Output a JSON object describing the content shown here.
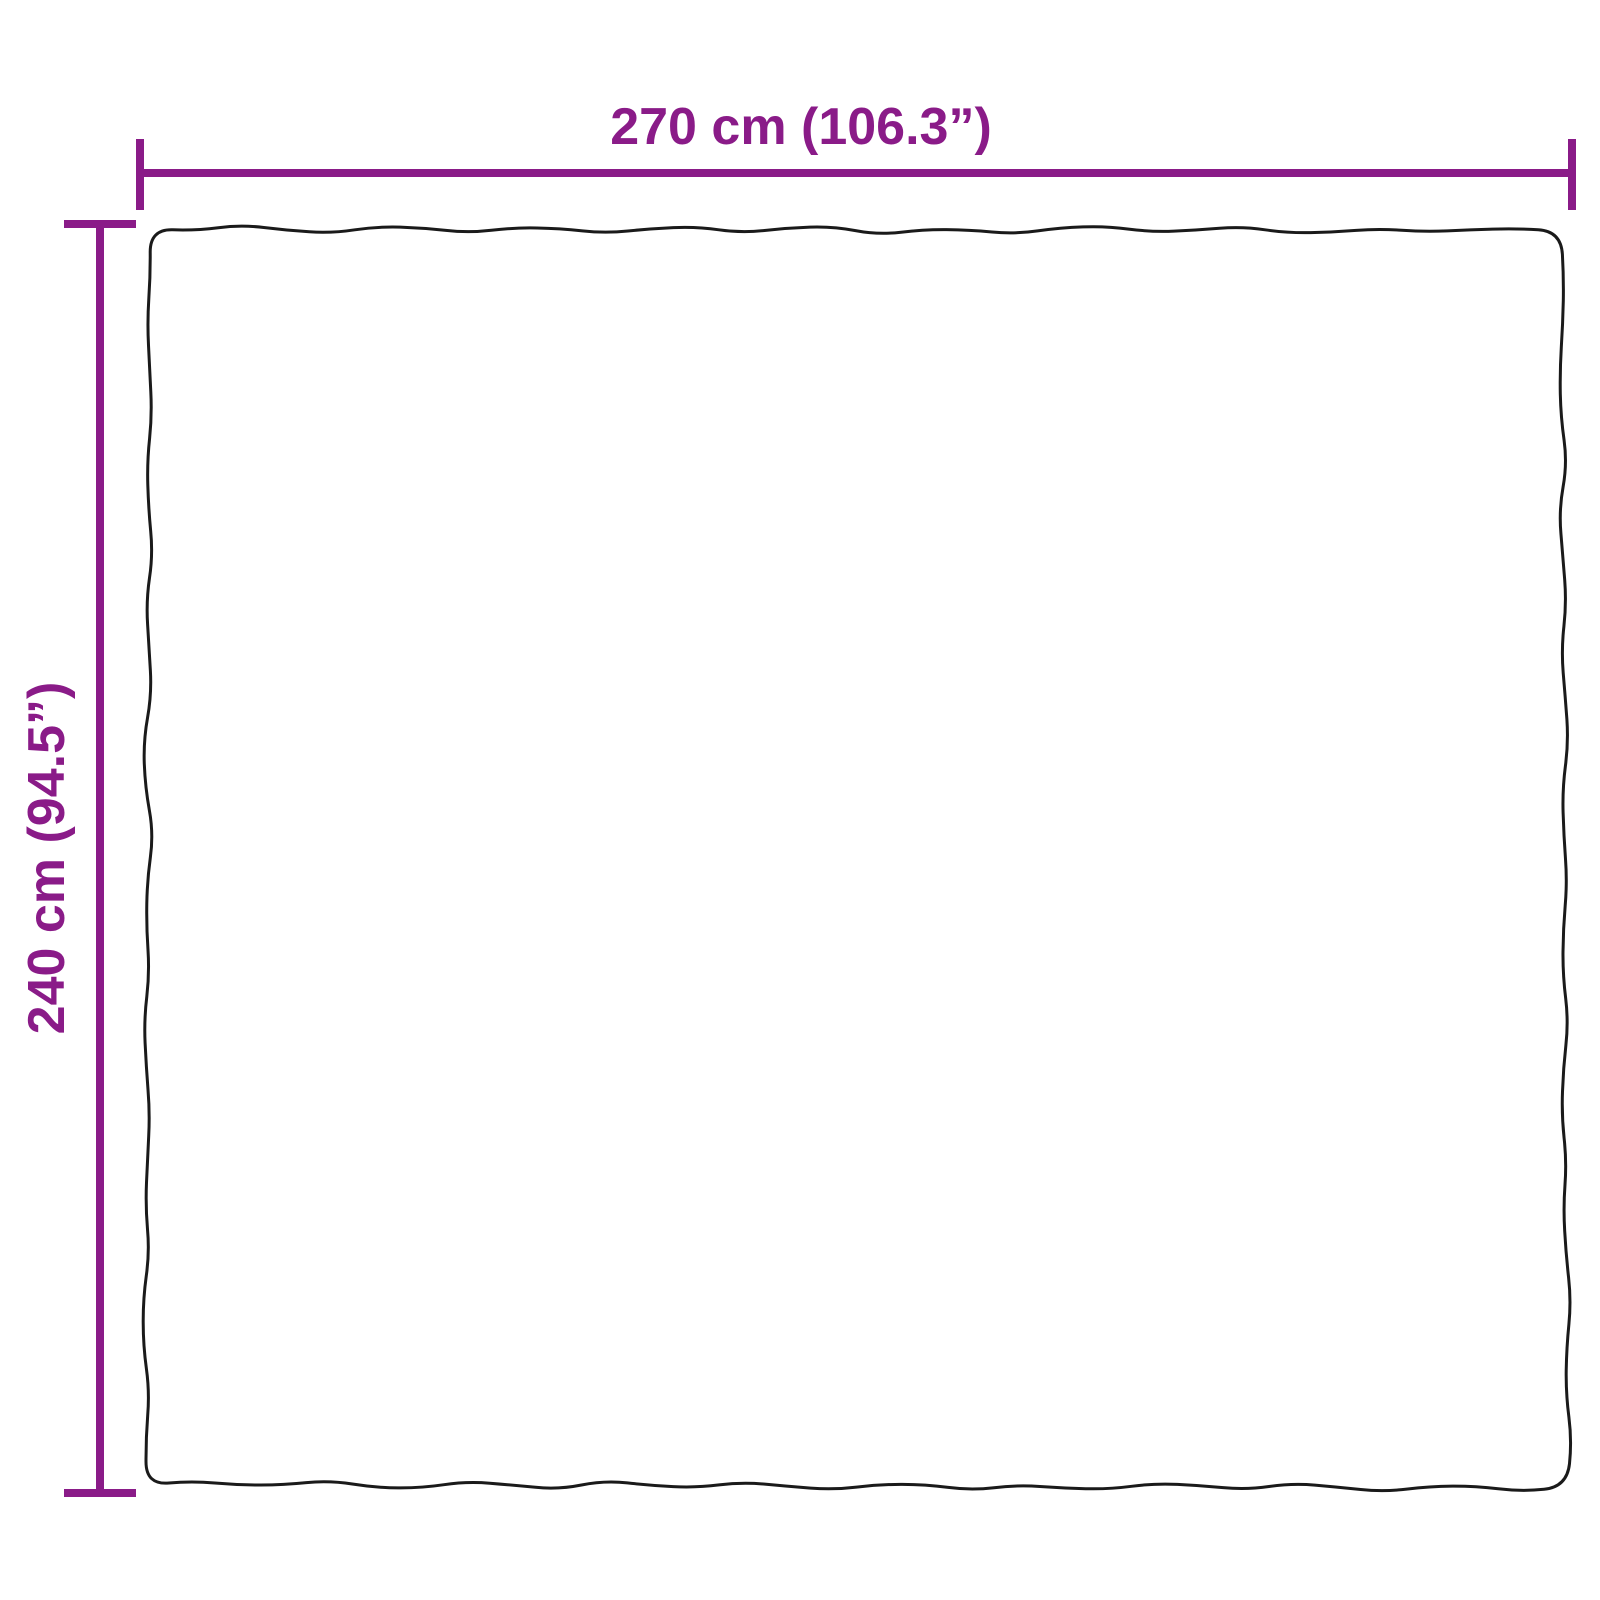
{
  "diagram": {
    "type": "product-dimension-diagram",
    "product_shape": "rectangular blanket/rug with wavy hand-drawn edges",
    "horizontal_dimension": {
      "label": "270 cm (106.3”)",
      "value_cm": 270,
      "value_inches": 106.3
    },
    "vertical_dimension": {
      "label": "240 cm (94.5”)",
      "value_cm": 240,
      "value_inches": 94.5
    },
    "colors": {
      "dimension_lines": "#8A1B88",
      "product_outline": "#1A1A1A",
      "background": "#FFFFFF"
    }
  }
}
